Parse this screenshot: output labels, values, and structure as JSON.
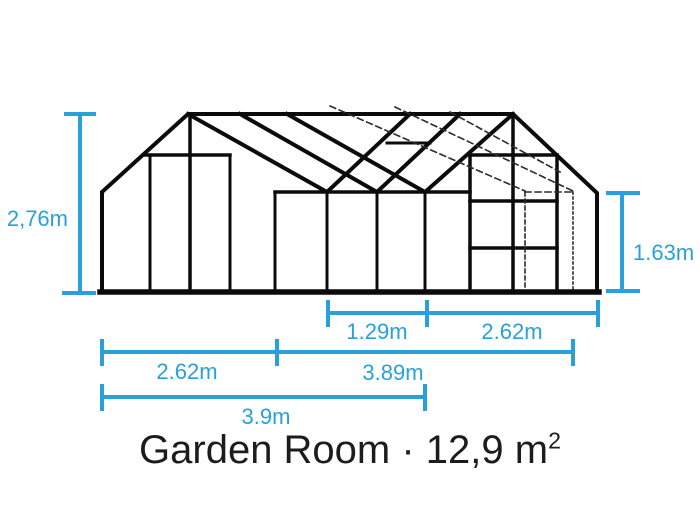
{
  "colors": {
    "accent_blue": "#2AA0DA",
    "line_black": "#0B0B0B",
    "title_text": "#1C1C1C",
    "background": "#FFFFFF"
  },
  "diagram": {
    "kind": "greenhouse elevation drawing with dimension lines",
    "labels": {
      "overall_height": "2,76m",
      "side_height": "1.63m",
      "door_bay_width": "1.29m",
      "right_section_width": "2.62m",
      "left_section_width": "2.62m",
      "main_section_width": "3.89m",
      "total_width": "3.9m"
    }
  },
  "title": {
    "text": "Garden Room · 12,9 m",
    "area_superscript": "2"
  }
}
